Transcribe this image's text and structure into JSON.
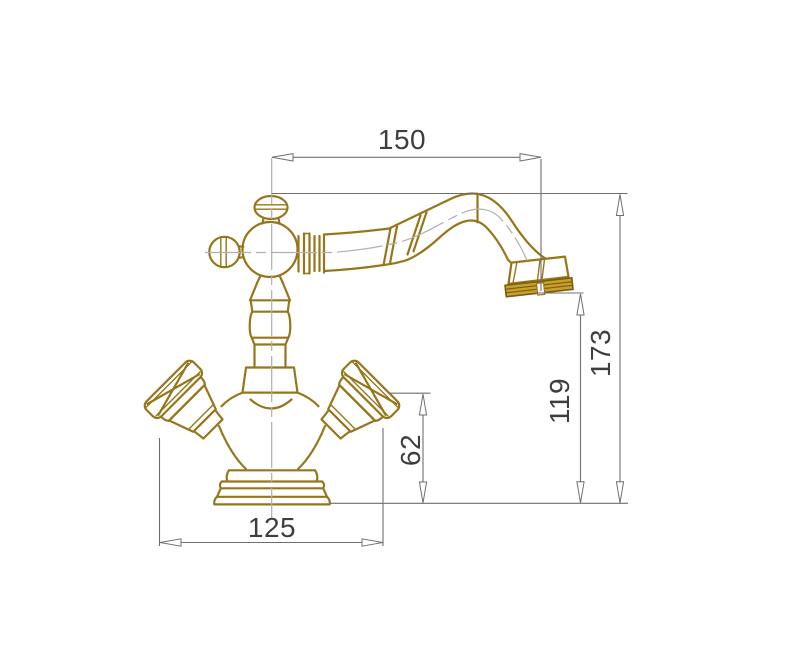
{
  "dimensions": [
    {
      "id": "spout-reach",
      "value": "150",
      "orientation": "horizontal"
    },
    {
      "id": "overall-height",
      "value": "173",
      "orientation": "vertical"
    },
    {
      "id": "spout-outlet-height",
      "value": "119",
      "orientation": "vertical"
    },
    {
      "id": "handle-top-height",
      "value": "62",
      "orientation": "vertical"
    },
    {
      "id": "body-width",
      "value": "125",
      "orientation": "horizontal"
    }
  ],
  "colors": {
    "line_gold": "#97761B",
    "fill_gold": "#C79F2B",
    "dark_gold": "#7B5C10",
    "centerline_gray": "#AFAFAF",
    "dimension_gray": "#6F6F6F",
    "text_gray": "#3E3E3E",
    "background": "#FFFFFF"
  }
}
